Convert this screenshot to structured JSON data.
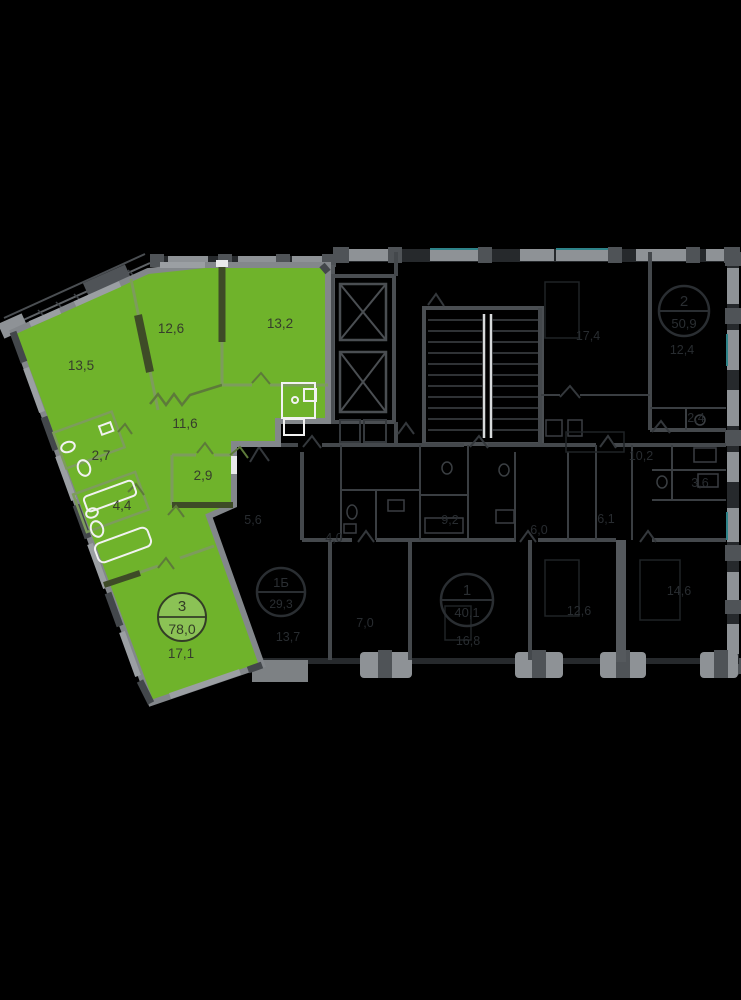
{
  "view": {
    "type": "residential-floor-plan",
    "highlight_color": "#6fb32b"
  },
  "colors": {
    "background": "#000000",
    "highlight_green": "#6fb32b",
    "outer_wall_gray": "#8e9296",
    "dim_wall_gray": "#44484c",
    "window_teal": "#2e8389",
    "green_label_dark": "#363d2c"
  },
  "apartment": {
    "badge": {
      "rooms": "3",
      "total_area": "78,0"
    },
    "rooms": [
      {
        "name": "room-13-5",
        "area": "13,5"
      },
      {
        "name": "room-12-6",
        "area": "12,6"
      },
      {
        "name": "room-13-2",
        "area": "13,2"
      },
      {
        "name": "hallway-11-6",
        "area": "11,6"
      },
      {
        "name": "bathroom-2-7",
        "area": "2,7"
      },
      {
        "name": "room-2-9",
        "area": "2,9"
      },
      {
        "name": "bathroom-4-4",
        "area": "4,4"
      },
      {
        "name": "room-17-1",
        "area": "17,1"
      }
    ]
  },
  "neighbors": {
    "badges": [
      {
        "rooms": "2",
        "total_area": "50,9"
      },
      {
        "rooms": "1Б",
        "total_area": "29,3"
      },
      {
        "rooms": "1",
        "total_area": "40,1"
      }
    ],
    "areas": [
      "17,4",
      "12,4",
      "10,2",
      "2,4",
      "3,6",
      "6,1",
      "6,0",
      "9,2",
      "4,0",
      "5,6",
      "7,0",
      "16,8",
      "13,7",
      "12,6",
      "14,6"
    ]
  }
}
